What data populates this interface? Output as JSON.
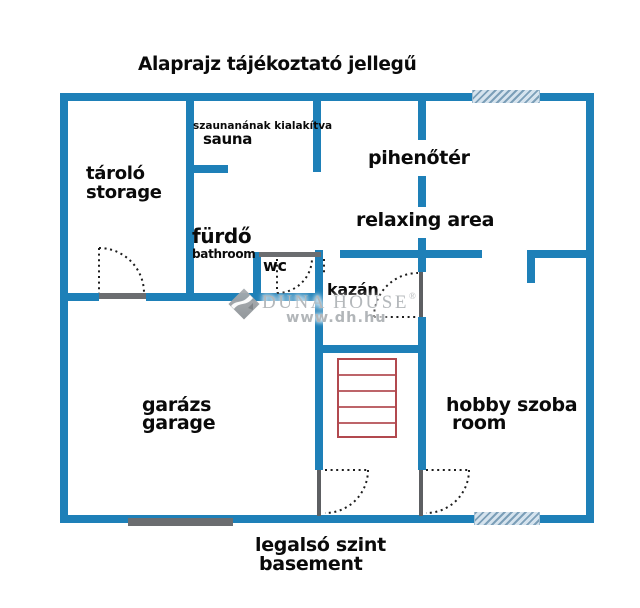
{
  "title": "Alaprajz tájékoztató jellegű",
  "rooms": {
    "storage": {
      "hu": "tároló",
      "en": "storage"
    },
    "sauna": {
      "note": "szaunanának kialakítva",
      "hu": "sauna"
    },
    "relaxing": {
      "hu": "pihenőtér",
      "en": "relaxing area"
    },
    "bathroom": {
      "hu": "fürdő",
      "en": "bathroom"
    },
    "wc": {
      "hu": "wc"
    },
    "boiler": {
      "hu": "kazán"
    },
    "garage": {
      "hu": "garázs",
      "en": "garage"
    },
    "hobby": {
      "hu": "hobby szoba",
      "en": "room"
    }
  },
  "footer": {
    "line1": "legalsó szint",
    "line2": "basement"
  },
  "watermark": {
    "brand": "DUNA HOUSE",
    "registered": "®",
    "url": "www.dh.hu"
  },
  "stairs": {
    "treads": 5
  },
  "colors": {
    "wall_blue": "#1e80b8",
    "stairs_red": "#b2494f",
    "detail_gray": "#6b6d70",
    "watermark_gray": "#b4b8bb",
    "text_black": "#0a0a0a"
  }
}
